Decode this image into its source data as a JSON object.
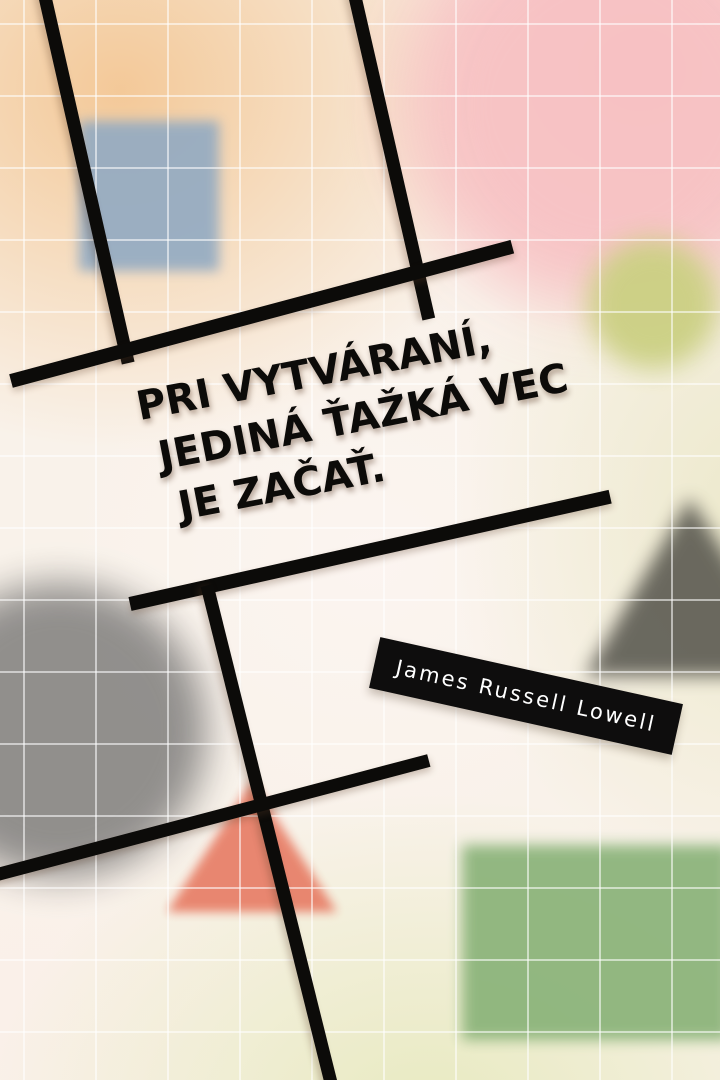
{
  "poster": {
    "quote": {
      "line1": "PRI VYTVÁRANÍ,",
      "line2": "JEDINÁ ŤAŽKÁ VEC",
      "line3": "JE ZAČAŤ."
    },
    "attribution": {
      "name": "James Russell Lowell"
    }
  },
  "colors": {
    "ink": "#0c0b09",
    "badge-bg": "#0e0d0d",
    "badge-text": "#ffffff",
    "grid-line": "#ffffff",
    "blue-square": "#8fa9c3",
    "pink-blob": "#f7c1c3",
    "yellow-green-circle": "#cbd083",
    "gray-circle": "#8c8a88",
    "dark-triangle": "#53524a",
    "salmon-triangle": "#e8816a",
    "green-square": "#8ab379",
    "bg-peach": "#f3c795",
    "bg-pink": "#f7c2c4",
    "bg-yellow-green": "#e6e9bc",
    "bg-base": "#f9f2ea"
  }
}
